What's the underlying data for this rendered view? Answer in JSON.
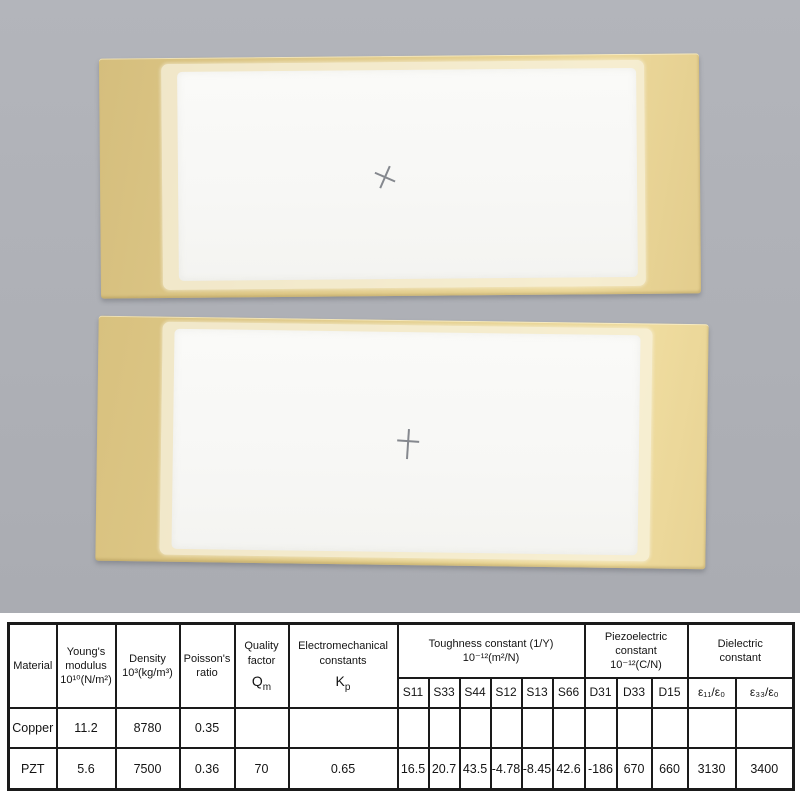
{
  "scene": {
    "backdrop_color": "#aeb0b6",
    "brass_color": "#e5d091",
    "pad_color": "#f8f8f6",
    "table_border_color": "#1a1a1a"
  },
  "table": {
    "headers": {
      "material": "Material",
      "youngs": "Young's\nmodulus\n10¹⁰(N/m²)",
      "density": "Density\n10³(kg/m³)",
      "poissons": "Poisson's\nratio",
      "quality": {
        "label": "Quality\nfactor",
        "symbol": "Q",
        "symbol_sub": "m"
      },
      "emc": {
        "label": "Electromechanical\nconstants",
        "symbol": "K",
        "symbol_sub": "p"
      },
      "toughness": "Toughness constant (1/Y)\n10⁻¹²(m²/N)",
      "piezo": "Piezoelectric\nconstant\n10⁻¹²(C/N)",
      "dielectric": "Dielectric\nconstant",
      "sub": [
        "S11",
        "S33",
        "S44",
        "S12",
        "S13",
        "S66",
        "D31",
        "D33",
        "D15",
        "ε₁₁/ε₀",
        "ε₃₃/ε₀"
      ]
    },
    "rows": [
      {
        "cells": [
          "Copper",
          "11.2",
          "8780",
          "0.35",
          "",
          "",
          "",
          "",
          "",
          "",
          "",
          "",
          "",
          "",
          "",
          "",
          ""
        ]
      },
      {
        "cells": [
          "PZT",
          "5.6",
          "7500",
          "0.36",
          "70",
          "0.65",
          "16.5",
          "20.7",
          "43.5",
          "-4.78",
          "-8.45",
          "42.6",
          "-186",
          "670",
          "660",
          "3130",
          "3400"
        ]
      }
    ]
  }
}
